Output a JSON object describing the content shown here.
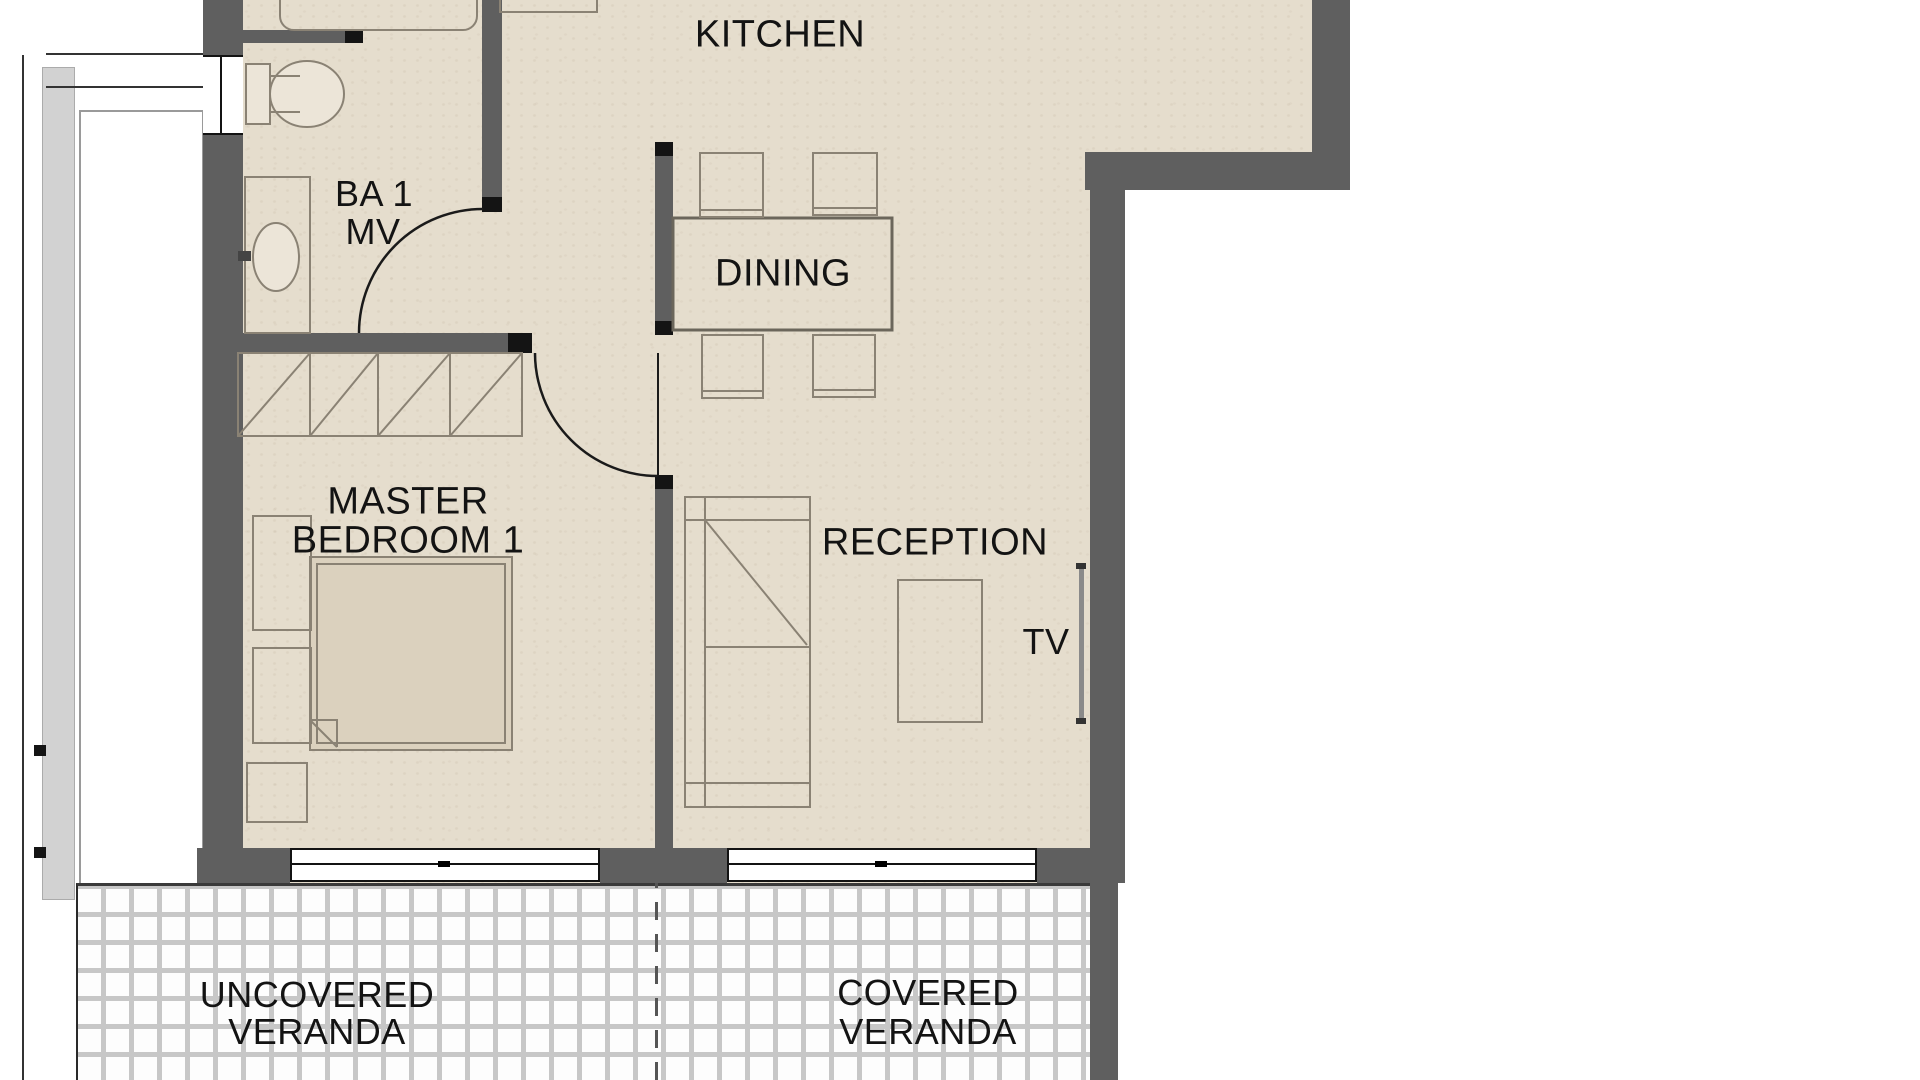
{
  "plan": {
    "title": "Apartment floor plan",
    "labels": {
      "kitchen": "KITCHEN",
      "bath_line1": "BA 1",
      "bath_line2": "MV",
      "dining": "DINING",
      "bedroom_line1": "MASTER",
      "bedroom_line2": "BEDROOM 1",
      "reception": "RECEPTION",
      "tv": "TV",
      "uncovered_veranda_line1": "UNCOVERED",
      "uncovered_veranda_line2": "VERANDA",
      "covered_veranda_line1": "COVERED",
      "covered_veranda_line2": "VERANDA"
    },
    "rooms": [
      {
        "name": "Kitchen"
      },
      {
        "name": "Bathroom 1 (MV)"
      },
      {
        "name": "Dining"
      },
      {
        "name": "Master Bedroom 1"
      },
      {
        "name": "Reception"
      },
      {
        "name": "Uncovered Veranda"
      },
      {
        "name": "Covered Veranda"
      }
    ],
    "colors": {
      "floor": "#e5ddcd",
      "wall": "#5f5f5f",
      "wall_cap": "#141414",
      "furniture_line": "#8a8274",
      "door_line": "#1a1a1a",
      "tile_grout": "#c7c7c7",
      "outside": "#ffffff"
    }
  }
}
